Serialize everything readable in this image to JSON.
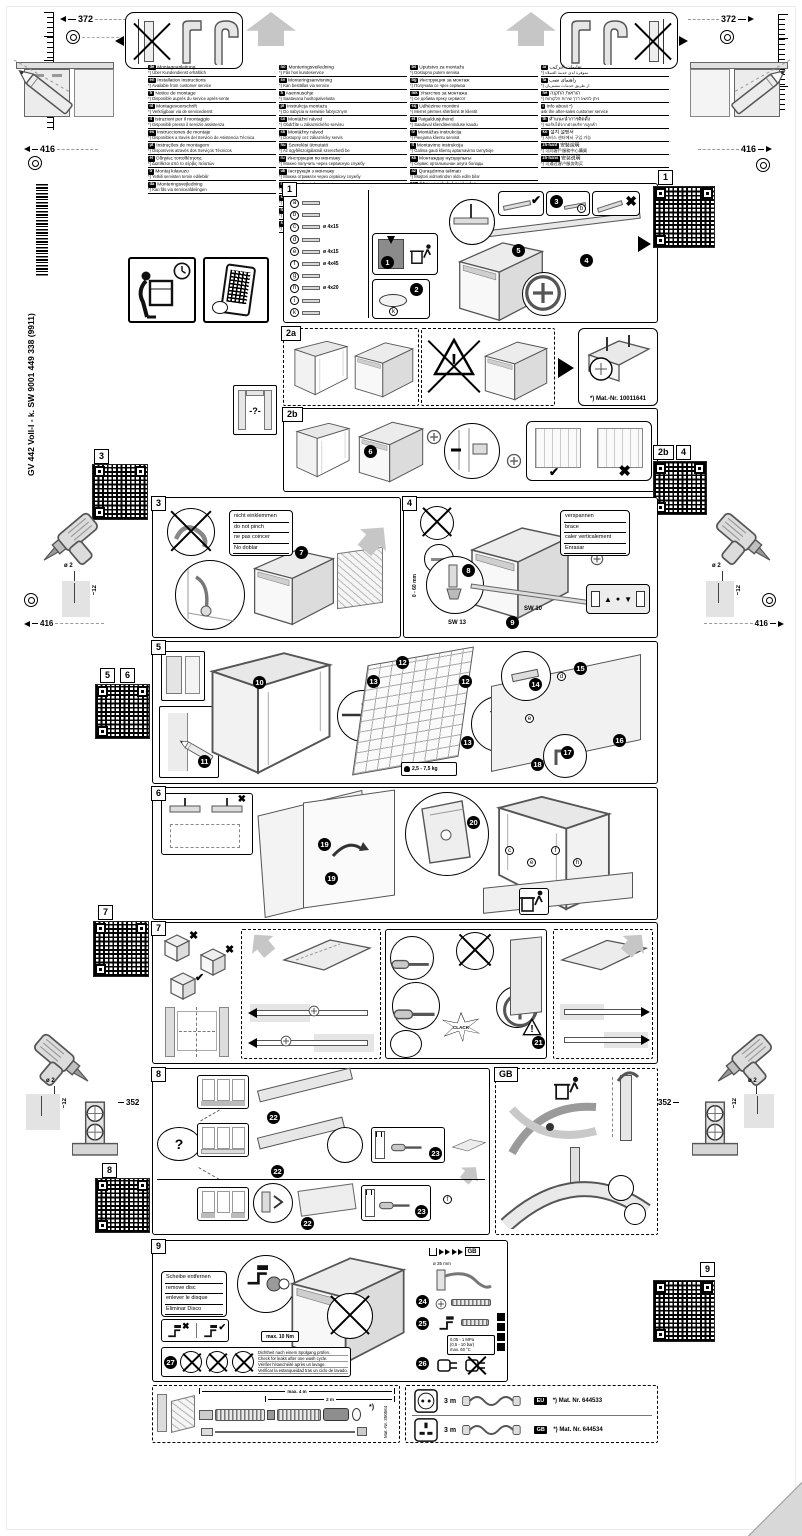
{
  "doc": {
    "code_vertical": "GV 442 Voll-I - k. SW  9001 449 338 (9911)"
  },
  "icons": {
    "check": "✔",
    "cross": "✖",
    "question": "?",
    "warning": "!"
  },
  "dims": {
    "top_left": "372",
    "top_right": "372",
    "mid_left": "416",
    "mid_right": "416",
    "drill_top_left": {
      "dia": "ø 2",
      "depth": "~12",
      "dist": "416"
    },
    "drill_top_right": {
      "dia": "ø 2",
      "depth": "~12",
      "dist": "416"
    },
    "drill_bottom_left": {
      "dia": "ø 2",
      "depth": "~12",
      "dist": "352"
    },
    "drill_bottom_right": {
      "dia": "ø 2",
      "depth": "~12",
      "dist": "352"
    }
  },
  "qr": {
    "top_right": "1",
    "left_a": "3",
    "left_b1": "5",
    "left_b2": "6",
    "left_c": "7",
    "left_d": "8",
    "right_a1": "2b",
    "right_a2": "4",
    "right_b": "9"
  },
  "languages": {
    "col1": [
      {
        "code": "de",
        "title": "Montageanleitung",
        "note": "*) Über Kundendienst erhältlich"
      },
      {
        "code": "en",
        "title": "Installation instructions",
        "note": "*) Available from customer service"
      },
      {
        "code": "fr",
        "title": "Notice de montage",
        "note": "*) Disponible auprès du service après-vente"
      },
      {
        "code": "nl",
        "title": "Montagevoorschrift",
        "note": "*) Verkrijgbaar via de servicedienst"
      },
      {
        "code": "it",
        "title": "Istruzioni per il montaggio",
        "note": "*) Disponibili presso il servizio assistenza"
      },
      {
        "code": "es",
        "title": "Instrucciones de montaje",
        "note": "*) Disponibles a través del Servicio de Asistencia Técnica"
      },
      {
        "code": "pt",
        "title": "Instruções de montagem",
        "note": "*) Disponíveis através dos Serviços Técnicos"
      },
      {
        "code": "el",
        "title": "Οδηγίες τοποθέτησης",
        "note": "*) Διατίθεται από το σέρβις πελατών"
      },
      {
        "code": "tr",
        "title": "Montaj kılavuzu",
        "note": "*) Yetkili servisten temin edilebilir"
      },
      {
        "code": "da",
        "title": "Monteringsvejledning",
        "note": "*) Kan fås via serviceafdelingen"
      }
    ],
    "col2": [
      {
        "code": "no",
        "title": "Monteringsveiledning",
        "note": "*) Fås hos kundeservice"
      },
      {
        "code": "sv",
        "title": "Monteringsanvisning",
        "note": "*) Kan beställas via service"
      },
      {
        "code": "fi",
        "title": "Asennusohje",
        "note": "*) Saatavana huoltopalvelusta"
      },
      {
        "code": "pl",
        "title": "Instrukcja montażu",
        "note": "*) Do nabycia w serwisie fabrycznym"
      },
      {
        "code": "cs",
        "title": "Montážní návod",
        "note": "*) Obdržíte u zákaznického servisu"
      },
      {
        "code": "sk",
        "title": "Montážny návod",
        "note": "*) Dostupný cez zákaznícky servis"
      },
      {
        "code": "hu",
        "title": "Szerelési útmutató",
        "note": "*) Az ügyfélszolgálatnál szerezhető be"
      },
      {
        "code": "ru",
        "title": "Инструкция по монтажу",
        "note": "*) Можно получить через сервисную службу"
      },
      {
        "code": "uk",
        "title": "Інструкція з монтажу",
        "note": "*) Можна отримати через сервісну службу"
      },
      {
        "code": "ro",
        "title": "Instrucţiuni de montaj",
        "note": "*) Se obţin prin unităţile de service"
      },
      {
        "code": "sl",
        "title": "Navodila za montažo",
        "note": "*) Na voljo pri servisni službi"
      },
      {
        "code": "hr",
        "title": "Upute za montažu",
        "note": "*) Dostupno preko servisne službe"
      },
      {
        "code": "sr",
        "title": "Uputstvo za montažu",
        "note": "*) Može se dobiti preko servisa"
      }
    ],
    "col3": [
      {
        "code": "bs",
        "title": "Uputstvo za montažu",
        "note": "*) Dostupno putem servisa"
      },
      {
        "code": "bg",
        "title": "Инструкция за монтаж",
        "note": "*) Получава се чрез сервиза"
      },
      {
        "code": "mk",
        "title": "Упатство за монтажа",
        "note": "*) Се добива преку сервисот"
      },
      {
        "code": "sq",
        "title": "Udhëzime montimi",
        "note": "*) Merret përmes shërbimit të klientit"
      },
      {
        "code": "et",
        "title": "Paigaldusjuhend",
        "note": "*) Saadaval klienditeeninduse kaudu"
      },
      {
        "code": "lv",
        "title": "Montāžas instrukcija",
        "note": "*) Pieejama klientu servisā"
      },
      {
        "code": "lt",
        "title": "Montavimo instrukcija",
        "note": "*) Galima gauti klientų aptarnavimo tarnyboje"
      },
      {
        "code": "kk",
        "title": "Монтаждау нұсқаулығы",
        "note": "*) Сервис орталығынан алуға болады"
      },
      {
        "code": "az",
        "title": "Quraşdırma təlimatı",
        "note": "*) Müştəri xidmətindən əldə edilə bilər"
      },
      {
        "code": "hy",
        "title": "Տեղադրման հրահանգ",
        "note": "*) Ձեռք բերվում է սպասարկման կենտրոնից"
      },
      {
        "code": "ka",
        "title": "მონტაჟის ინსტრუქცია",
        "note": "*) კლიენტთა სერვისის მეშვეობით"
      }
    ],
    "col4": [
      {
        "code": "ar",
        "title": "تعليمات التركيب",
        "note": "*) متوفرة لدى خدمة العملاء"
      },
      {
        "code": "fa",
        "title": "راهنمای نصب",
        "note": "*) از طریق خدمات مشتریان"
      },
      {
        "code": "he",
        "title": "הוראות התקנה",
        "note": "*) ניתן להשיג דרך שירות הלקוחות"
      },
      {
        "code": "i",
        "title": "Info about *)",
        "note": "ask the after-sales customer service"
      },
      {
        "code": "th",
        "title": "คำแนะนำการติดตั้ง",
        "note": "*) ขอรับได้จากฝ่ายบริการลูกค้า"
      },
      {
        "code": "ko",
        "title": "설치 설명서",
        "note": "*) 서비스 센터에서 구입 가능"
      },
      {
        "code": "zh-hant",
        "title": "安裝說明",
        "note": "*) 可向客戶服務中心購買"
      },
      {
        "code": "zh-hans",
        "title": "安装说明",
        "note": "*) 可通过客户服务购买"
      }
    ]
  },
  "panel1": {
    "label": "1",
    "steps": [
      "1",
      "2",
      "3",
      "4",
      "5"
    ],
    "ref": "b",
    "parts": [
      {
        "id": "a",
        "note": ""
      },
      {
        "id": "b",
        "note": ""
      },
      {
        "id": "c",
        "note": "ø 4x15"
      },
      {
        "id": "d",
        "note": ""
      },
      {
        "id": "e",
        "note": "ø 4x15"
      },
      {
        "id": "f",
        "note": "ø 4x45"
      },
      {
        "id": "g",
        "note": ""
      },
      {
        "id": "h",
        "note": "ø 4x20"
      },
      {
        "id": "i",
        "note": ""
      },
      {
        "id": "k",
        "note": ""
      }
    ]
  },
  "panel2a": {
    "label": "2a",
    "mat_nr": "*) Mat.-Nr. 10011641"
  },
  "niche_unknown": {
    "text": "-?-"
  },
  "panel2b": {
    "label": "2b",
    "step": "6"
  },
  "panel3": {
    "label": "3",
    "step": "7",
    "notes": [
      "nicht einklemmen",
      "do not pinch",
      "ne pas coincer",
      "No doblar"
    ]
  },
  "panel4": {
    "label": "4",
    "steps": [
      "8",
      "9"
    ],
    "notes": [
      "verspannen",
      "brace",
      "caler verticalement",
      "Enrasar"
    ],
    "sw13": "SW 13",
    "sw10": "SW 10",
    "range": "0 - 60 mm"
  },
  "panel5": {
    "label": "5",
    "steps": [
      "10",
      "11",
      "12",
      "13",
      "14",
      "15",
      "16",
      "17",
      "18"
    ],
    "weight": "2,5 - 7,5 kg",
    "refs": [
      "d",
      "e"
    ]
  },
  "panel6": {
    "label": "6",
    "steps": [
      "19",
      "20"
    ],
    "refs": [
      "c",
      "e",
      "f",
      "h"
    ]
  },
  "panel7": {
    "label": "7",
    "step": "21",
    "clack": "CLACK"
  },
  "panel8": {
    "label": "8",
    "steps": [
      "22",
      "23"
    ],
    "question": "?"
  },
  "panel_gb": {
    "label": "GB"
  },
  "panel9": {
    "label": "9",
    "steps": [
      "24",
      "25",
      "26",
      "27"
    ],
    "notes": [
      "Scheibe entfernen",
      "remove disc",
      "enlever le disque",
      "Eliminar Disco"
    ],
    "torque": "max. 10 Nm",
    "gb_ref": "GB",
    "hose_dia": "ø 35 mm",
    "pressure": [
      "0,05 - 1 MPa",
      "(0,5 - 10 bar)",
      "max. 60 °C"
    ],
    "leak": [
      "Dichtheit nach einem Spülgang prüfen.",
      "Check for leaks after one wash cycle.",
      "Vérifier l'étanchéité après un lavage.",
      "Verificar la estanqueidad tras un ciclo de lavado."
    ]
  },
  "hose_extension": {
    "dim_total": "max. 4 m",
    "dim_mid": "2 m",
    "mat_nr": "Mat.-Nr. 350564",
    "star": "*)"
  },
  "power_cords": [
    {
      "socket": "EU",
      "length": "3 m",
      "badge": "EU",
      "mat": "*) Mat. Nr. 644533"
    },
    {
      "socket": "GB",
      "length": "3 m",
      "badge": "GB",
      "mat": "*) Mat. Nr. 644534"
    }
  ]
}
